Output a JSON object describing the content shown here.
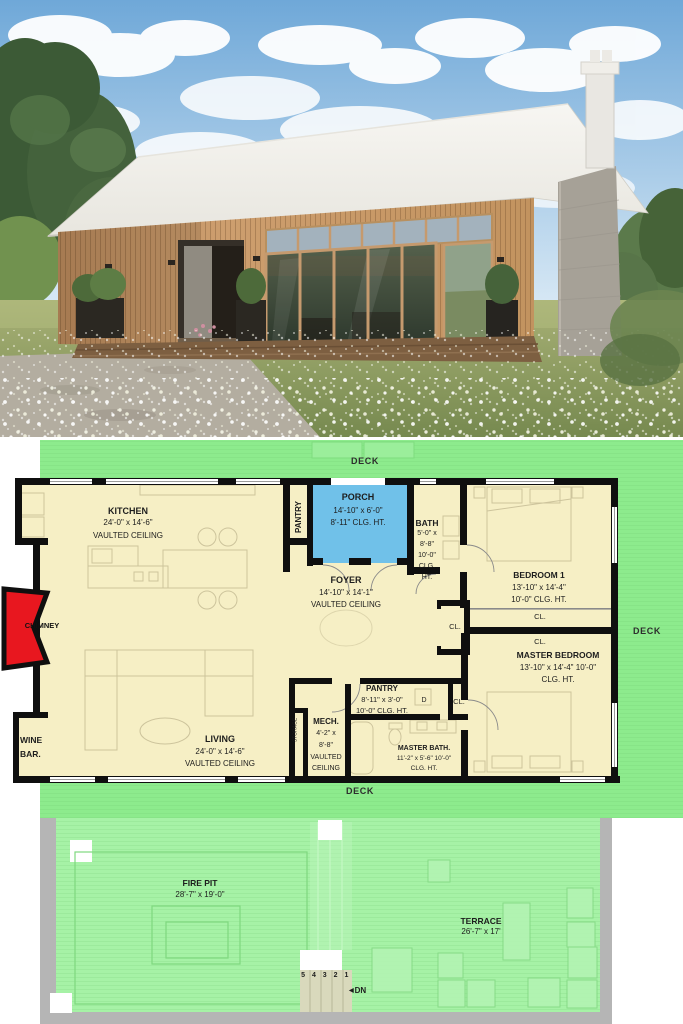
{
  "plan": {
    "deck_top": "DECK",
    "deck_right": "DECK",
    "deck_bottom": "DECK",
    "closet_label": "CL.",
    "dryer": "D",
    "stairs": {
      "numbers": "5 4 3 2 1",
      "arrow": "◀",
      "dn": "DN"
    },
    "rooms": {
      "kitchen": {
        "name": "KITCHEN",
        "dims": "24'-0\" x 14'-6\"",
        "note": "VAULTED CEILING"
      },
      "pantry_upper": {
        "name": "PANTRY"
      },
      "porch": {
        "name": "PORCH",
        "dims": "14'-10\" x 6'-0\"",
        "note": "8'-11\" CLG. HT."
      },
      "bath": {
        "name": "BATH",
        "line1": "5'-0\" x",
        "line2": "8'-8\"",
        "line3": "10'-0\"",
        "line4": "CLG.",
        "line5": "HT."
      },
      "foyer": {
        "name": "FOYER",
        "dims": "14'-10\" x 14'-1\"",
        "note": "VAULTED CEILING"
      },
      "bedroom1": {
        "name": "BEDROOM 1",
        "dims": "13'-10\" x 14'-4\"",
        "note": "10'-0\" CLG. HT."
      },
      "master_bedroom": {
        "name": "MASTER BEDROOM",
        "dims": "13'-10\" x 14'-4\" 10'-0\"",
        "note": "CLG. HT."
      },
      "pantry_lower": {
        "name": "PANTRY",
        "dims": "8'-11\" x 3'-0\"",
        "note": "10'-0\" CLG. HT."
      },
      "mech": {
        "name": "MECH.",
        "line1": "4'-2\" x",
        "line2": "8'-8\"",
        "line3": "VAULTED",
        "line4": "CEILING"
      },
      "storage": {
        "name": "STORAGE"
      },
      "master_bath": {
        "name": "MASTER BATH.",
        "dims": "11'-2\" x 5'-6\" 10'-0\"",
        "note": "CLG. HT."
      },
      "living": {
        "name": "LIVING",
        "dims": "24'-0\" x 14'-6\"",
        "note": "VAULTED CEILING"
      },
      "wine_bar": {
        "line1": "WINE",
        "line2": "BAR."
      },
      "chimney": {
        "name": "CHIMNEY"
      },
      "fire_pit": {
        "name": "FIRE PIT",
        "dims": "28'-7\" x 19'-0\""
      },
      "terrace": {
        "name": "TERRACE",
        "dims": "26'-7\" x 17'"
      }
    }
  },
  "colors": {
    "deck_green": "#8deb8d",
    "patio_green": "#a6f2a6",
    "room_cream": "#f6efc5",
    "porch_blue": "#70c1e9",
    "chimney_red": "#e8171f",
    "wall_black": "#0f0f0f",
    "walkway_gray": "#b5b5b5",
    "stair_tan": "#d9d9bc"
  }
}
